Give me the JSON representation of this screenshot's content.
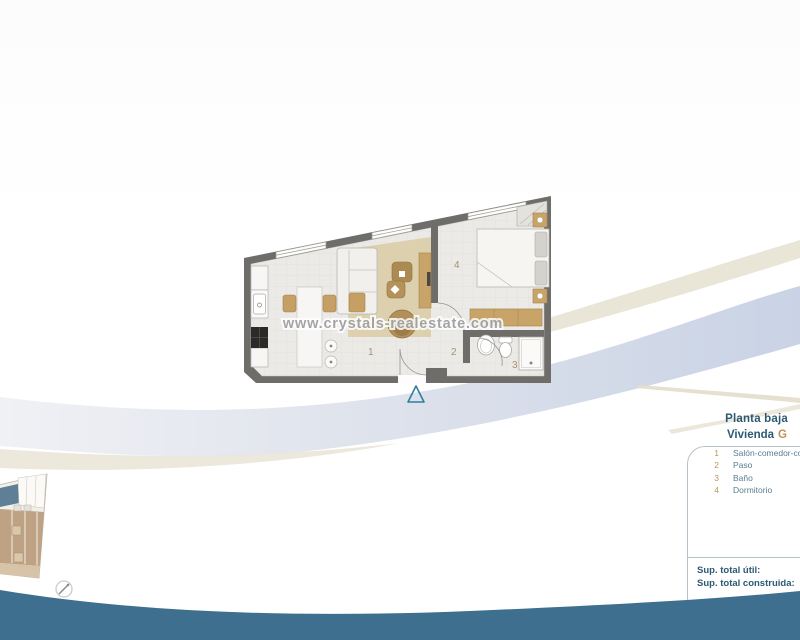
{
  "header": {
    "floor": "Planta baja",
    "dwelling": "Vivienda",
    "unit": "G"
  },
  "legend": {
    "items": [
      {
        "num": "1",
        "label": "Salón-comedor-cocina"
      },
      {
        "num": "2",
        "label": "Paso"
      },
      {
        "num": "3",
        "label": "Baño"
      },
      {
        "num": "4",
        "label": "Dormitorio"
      }
    ]
  },
  "totals": {
    "useful": "Sup. total útil:",
    "built": "Sup. total construida:"
  },
  "watermark": "www.crystals-realestate.com",
  "plan": {
    "room_labels": [
      "1",
      "2",
      "3",
      "4"
    ]
  },
  "colors": {
    "heading_blue": "#2c5a73",
    "accent_tan": "#c68f55",
    "legend_text": "#587d91",
    "bottom_band": "#3e6f8e",
    "ribbon_blue": "#c9d3e5",
    "ribbon_beige": "#e8e3d3",
    "wall_gray": "#6f6d6a",
    "furniture_tan": "#c59f63"
  }
}
